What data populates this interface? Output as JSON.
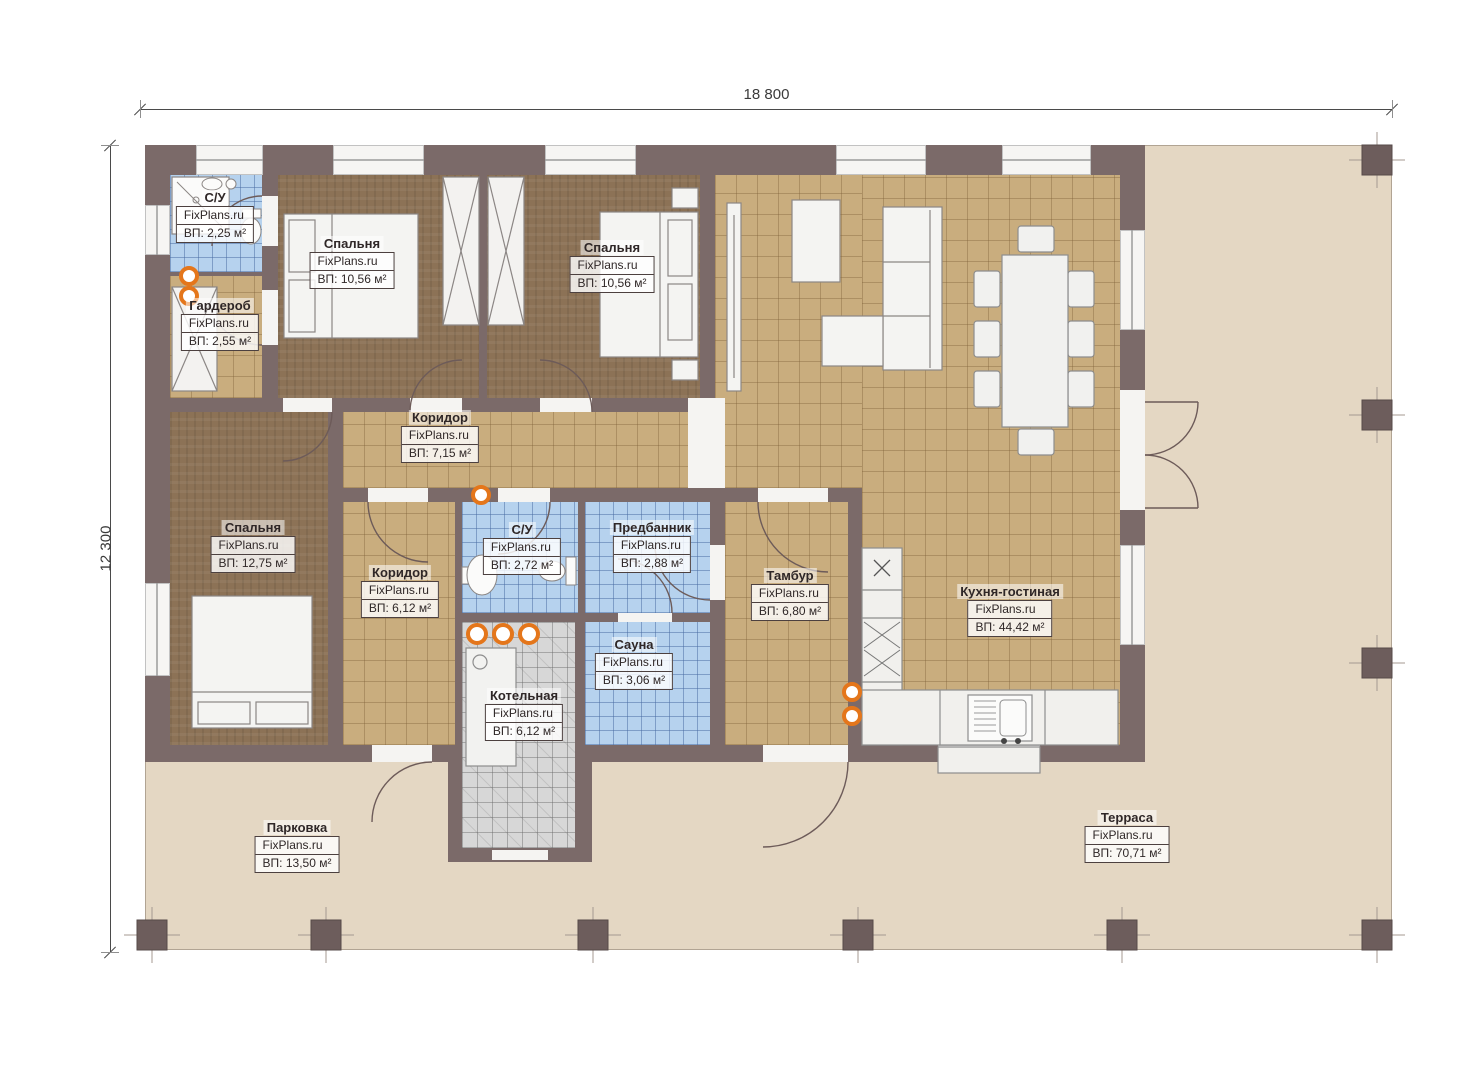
{
  "dimensions": {
    "width": "18 800",
    "height": "12 300"
  },
  "brand": "FixPlans.ru",
  "rooms": {
    "su1": {
      "name": "С/У",
      "area": "ВП: 2,25 м²"
    },
    "garderob": {
      "name": "Гардероб",
      "area": "ВП: 2,55 м²"
    },
    "bedroom1": {
      "name": "Спальня",
      "area": "ВП: 10,56 м²"
    },
    "bedroom2": {
      "name": "Спальня",
      "area": "ВП: 10,56 м²"
    },
    "corridor1": {
      "name": "Коридор",
      "area": "ВП: 7,15 м²"
    },
    "bedroom3": {
      "name": "Спальня",
      "area": "ВП: 12,75 м²"
    },
    "corridor2": {
      "name": "Коридор",
      "area": "ВП: 6,12 м²"
    },
    "su2": {
      "name": "С/У",
      "area": "ВП: 2,72 м²"
    },
    "predbannik": {
      "name": "Предбанник",
      "area": "ВП: 2,88 м²"
    },
    "sauna": {
      "name": "Сауна",
      "area": "ВП: 3,06 м²"
    },
    "kotelnaya": {
      "name": "Котельная",
      "area": "ВП: 6,12 м²"
    },
    "tambur": {
      "name": "Тамбур",
      "area": "ВП: 6,80 м²"
    },
    "kitchen": {
      "name": "Кухня-гостиная",
      "area": "ВП: 44,42 м²"
    },
    "parking": {
      "name": "Парковка",
      "area": "ВП: 13,50 м²"
    },
    "terrace": {
      "name": "Терраса",
      "area": "ВП: 70,71 м²"
    }
  },
  "colors": {
    "wall": "#7b6a69",
    "tile_tan": "#c9ad7e",
    "tile_blue": "#b6d2ee",
    "floor_wood": "#8c7256",
    "tile_gray": "#d7d7d7",
    "terrace": "#e4d7c3",
    "accent_orange": "#e4761b"
  }
}
